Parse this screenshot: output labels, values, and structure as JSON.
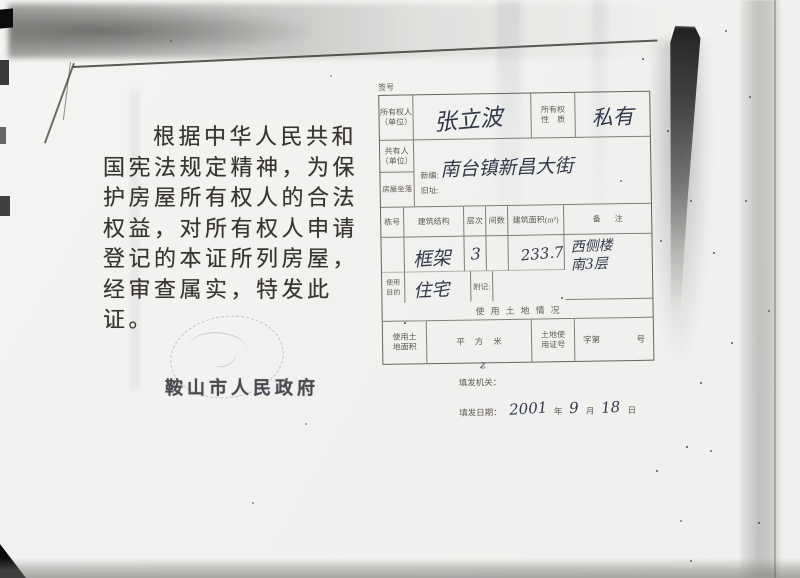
{
  "intro": {
    "lines": [
      "根据中华人民共和",
      "国宪法规定精神，为保",
      "护房屋所有权人的合法",
      "权益，对所有权人申请",
      "登记的本证所列房屋，",
      "经审查属实，特发此证。"
    ]
  },
  "issuer": {
    "name": "鞍山市人民政府"
  },
  "form": {
    "serial_label": "签号",
    "owner": {
      "label": "所有权人",
      "label2": "（单位）",
      "value": "张立波"
    },
    "nature": {
      "label": "所有权",
      "label2": "性质",
      "value": "私有"
    },
    "co_owner": {
      "label": "共有人",
      "label2": "（单位）"
    },
    "location": {
      "label": "房屋坐落",
      "new_label": "新编:",
      "new_value": "南台镇新昌大街",
      "old_label": "旧址:"
    },
    "building_table": {
      "headers": [
        "栋号",
        "建筑结构",
        "层次",
        "间数",
        "建筑面积(m²)",
        "备注"
      ],
      "row": {
        "structure": "框架",
        "floors": "3",
        "rooms": "",
        "area": "233.76",
        "remark_line1": "西侧楼",
        "remark_line2": "南3层"
      }
    },
    "purpose": {
      "label": "使用",
      "label2": "目的",
      "value": "住宅"
    },
    "note_label": "附记:",
    "land": {
      "title": "使用土地情况",
      "area_label": "使用土",
      "area_label2": "地面积",
      "unit": "平方米",
      "cert_label": "土地使",
      "cert_label2": "用证号",
      "cert_prefix": "字第",
      "cert_suffix": "号"
    },
    "footer": {
      "org_label": "填发机关：",
      "date_label": "填发日期：",
      "year": "2001",
      "year_unit": "年",
      "month": "9",
      "month_unit": "月",
      "day": "18",
      "day_unit": "日"
    }
  },
  "colors": {
    "ink": "#33394a",
    "paper": "#f2f2f0"
  }
}
